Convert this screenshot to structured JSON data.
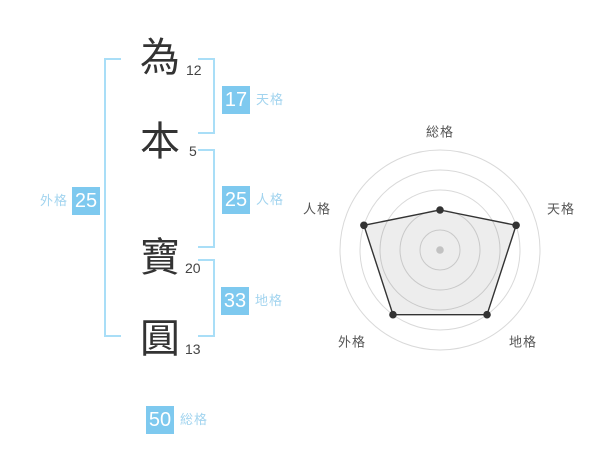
{
  "name_panel": {
    "characters": [
      {
        "char": "為",
        "strokes": "12"
      },
      {
        "char": "本",
        "strokes": "5"
      },
      {
        "char": "寶",
        "strokes": "20"
      },
      {
        "char": "圓",
        "strokes": "13"
      }
    ],
    "badges": {
      "tenkaku": {
        "value": "17",
        "label": "天格"
      },
      "jinkaku": {
        "value": "25",
        "label": "人格"
      },
      "chikaku": {
        "value": "33",
        "label": "地格"
      },
      "gaikaku": {
        "value": "25",
        "label": "外格"
      },
      "soukaku": {
        "value": "50",
        "label": "総格"
      }
    }
  },
  "colors": {
    "badge_blue": "#7ec9ef",
    "bracket_blue": "#a9def7",
    "label_blue": "#a2d4ef",
    "ink": "#333333",
    "chart_grid": "#d9d9d9",
    "chart_line": "#333333",
    "chart_fill": "rgba(0,0,0,0.07)",
    "chart_center_dot": "#c2c2c2",
    "chart_label": "#555555"
  },
  "chart_data": {
    "type": "radar",
    "title": "",
    "categories": [
      "総格",
      "天格",
      "地格",
      "外格",
      "人格"
    ],
    "values": [
      2,
      4,
      4,
      4,
      4
    ],
    "max": 5,
    "rings": 5,
    "start_angle_deg": -90,
    "direction": "clockwise",
    "grid": "concentric-circles",
    "legend": false
  }
}
